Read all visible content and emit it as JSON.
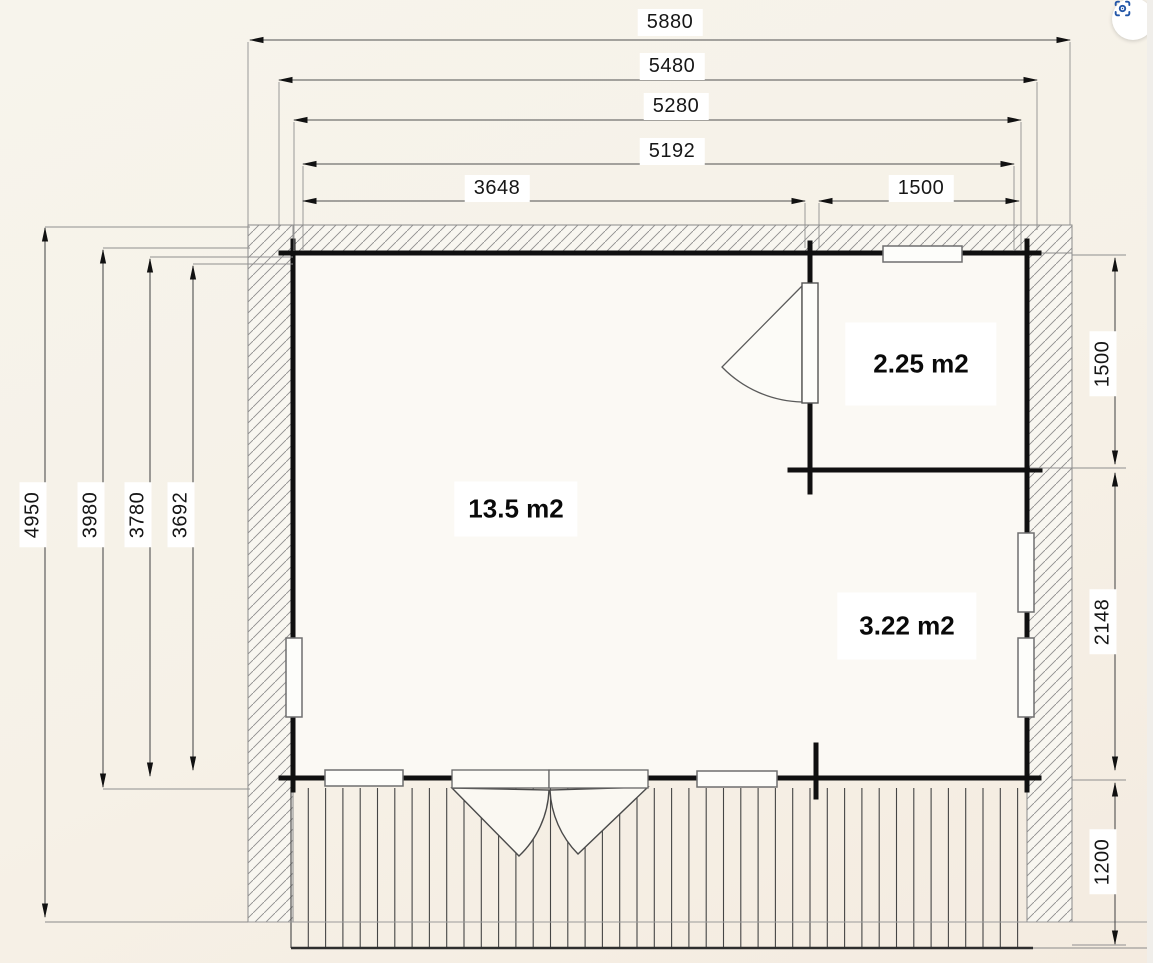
{
  "plan": {
    "top_dims": [
      "5880",
      "5480",
      "5280",
      "5192",
      "3648",
      "1500"
    ],
    "left_dims": [
      "4950",
      "3980",
      "3780",
      "3692"
    ],
    "right_dims": [
      "1500",
      "2148",
      "1200"
    ],
    "room_areas": [
      "13.5 m2",
      "2.25 m2",
      "3.22 m2"
    ]
  },
  "controls": {
    "visual_search_icon": "visual-search"
  },
  "colors": {
    "paper": "#f6f2e9",
    "wall_line": "#101010",
    "thin_line": "#8a8a8a",
    "dim_line": "#505050",
    "accent_blue": "#2356a7"
  }
}
